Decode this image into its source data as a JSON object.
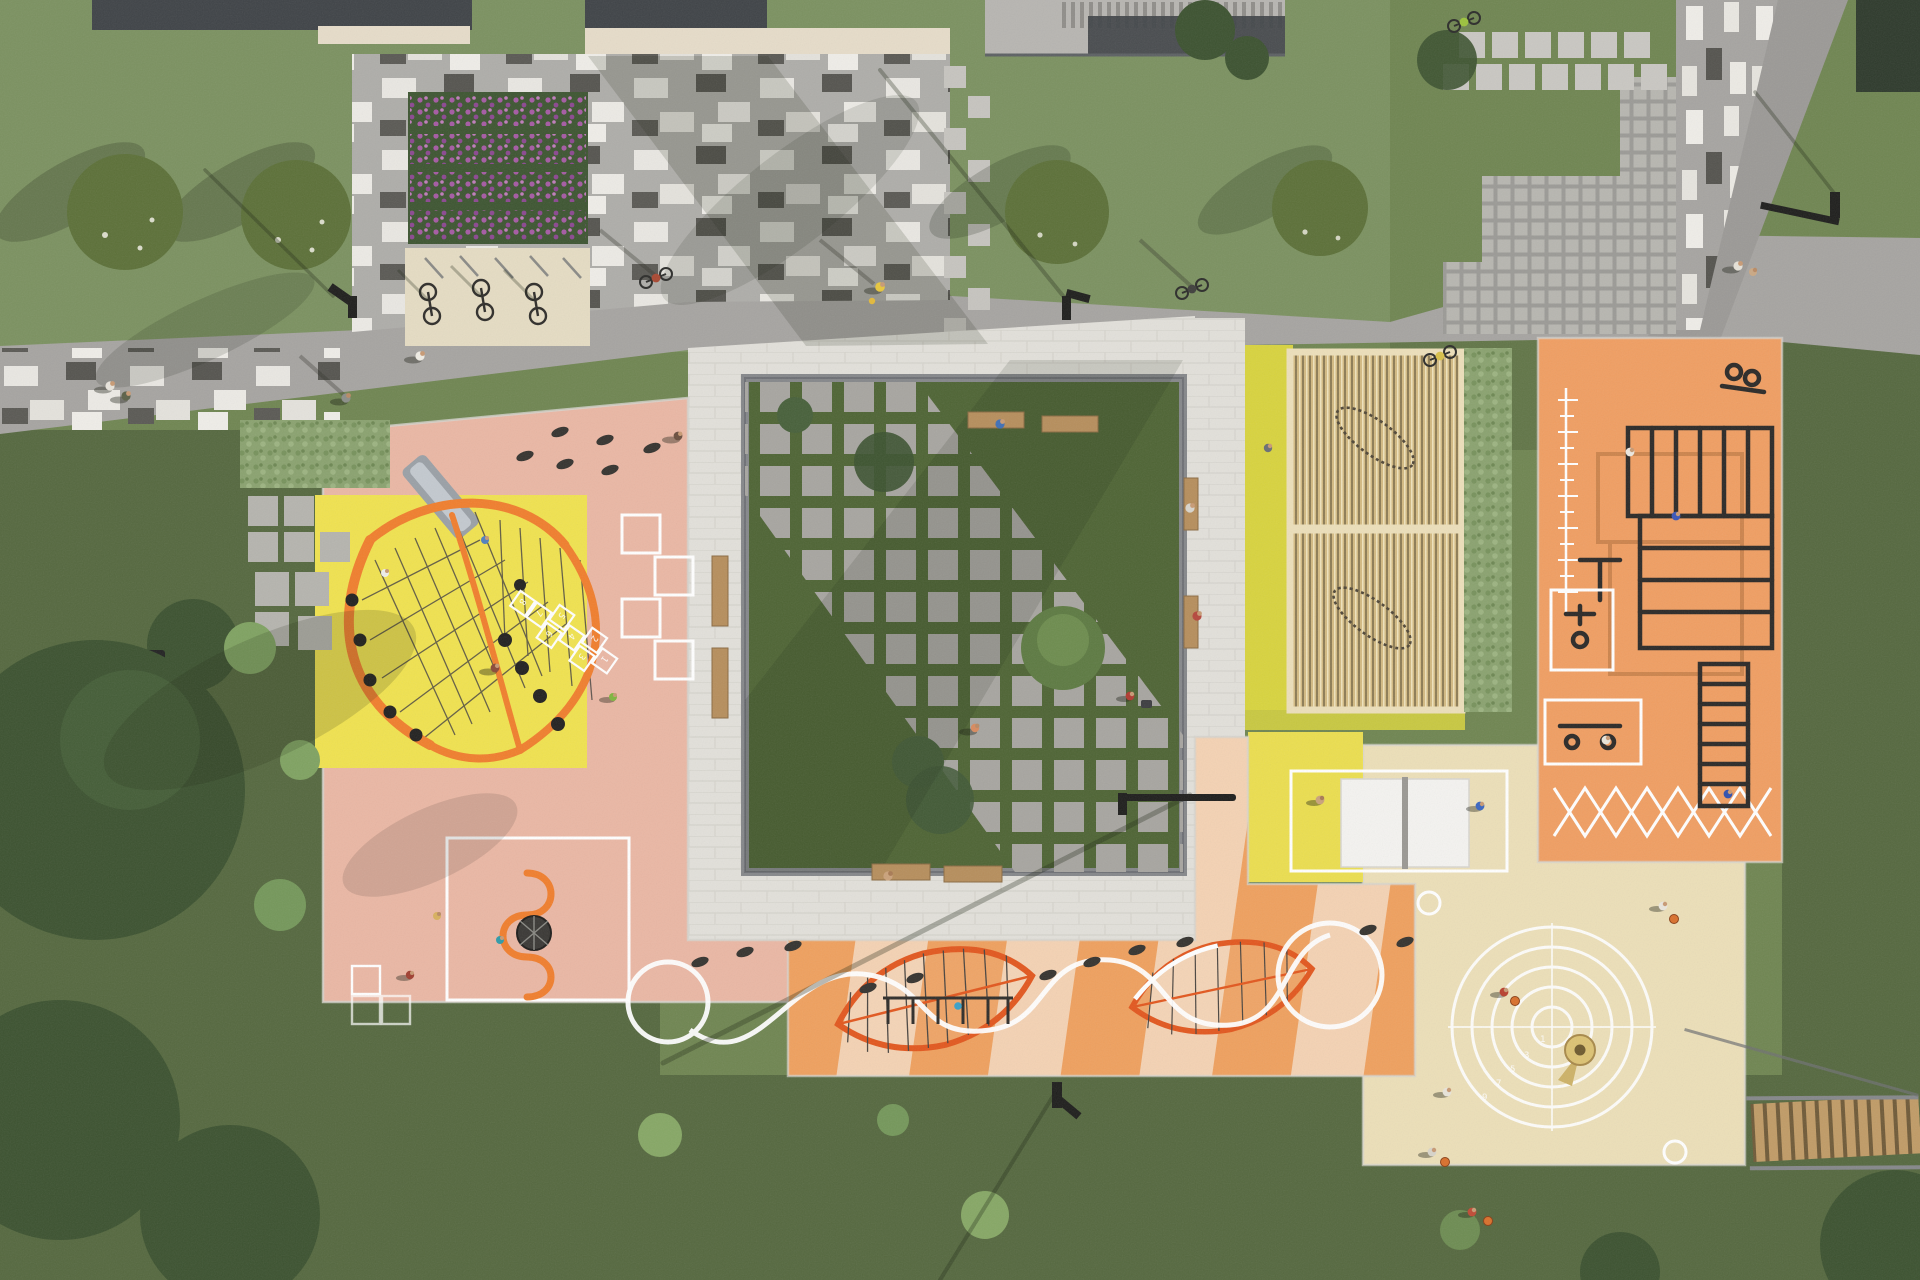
{
  "meta": {
    "description": "Top-down aerial 3D architectural render of a public park and playground masterplan",
    "render_style": "photorealistic site-plan visualization, no UI text"
  },
  "palette": {
    "c-grass": "#6f8551",
    "c-grass_light": "#7b9160",
    "c-grass_dark": "#55683f",
    "c-canopy": "#3c5230",
    "c-road": "#a6a4a1",
    "c-road_dark": "#9b9996",
    "c-plaza": "#aeada9",
    "c-paver_white": "#e2e0da",
    "c-lawn": "#4e6434",
    "c-wall": "#85878a",
    "c-wood": "#b68e5c",
    "c-pink": "#eab7a4",
    "c-yellow": "#f0e24f",
    "c-orange_frame": "#f07e2d",
    "c-lounge": "#d8d33e",
    "c-pergola": "#d3ba82",
    "c-fitness": "#f09e62",
    "c-stripe_o": "#efa05e",
    "c-stripe_c": "#f4d2b3",
    "c-leaf": "#e2571e",
    "c-beige": "#ecdfb8",
    "c-white": "#ffffff",
    "c-black": "#2b2927",
    "c-flower": "#a55aa3",
    "c-roof": "#3f4347",
    "c-trim": "#e6dcc9",
    "c-deck": "#b7b5b1",
    "c-stairs": "#c09b66"
  },
  "zones": [
    {
      "id": "north-lawn",
      "name": "Lawn with two flowering trees"
    },
    {
      "id": "flower-beds",
      "name": "Four rows of purple perennial planting"
    },
    {
      "id": "bicycle-parking",
      "name": "Bicycle racks with parked bikes on a sand pad"
    },
    {
      "id": "cobble-plaza",
      "name": "Grey plaza with scattered white and dark pavers"
    },
    {
      "id": "promenade",
      "name": "Grey paved pedestrian promenade with cyclists and walkers"
    },
    {
      "id": "northeast-path",
      "name": "Paver path with scattered vertical white setts and diagonal side road"
    },
    {
      "id": "grid-paver-terrace",
      "name": "Stepped lawn-grid paver terrace with stepping-stone rows"
    },
    {
      "id": "central-square",
      "name": "Sunken green square with stone seat-edge, timber benches and diagonal stepping-stone band"
    },
    {
      "id": "playground-west",
      "name": "Salmon play surface: yellow net-climber square with slide, balance pods, hopscotch, white game frames, wheel spinner"
    },
    {
      "id": "hammock-lounge",
      "name": "Two timber-slat pergolas with hammocks on chartreuse surface"
    },
    {
      "id": "hedge-screen",
      "name": "Shrub hedge between lounge and workout court"
    },
    {
      "id": "calisthenics-court",
      "name": "Orange workout court: monkey bars, ladders, pull-up rigs, two machine stations, agility-ladder and X markings"
    },
    {
      "id": "playground-south",
      "name": "Striped orange surface with leaf-shaped climbing nets, white wave rope, balance pods and mini swing frame"
    },
    {
      "id": "table-tennis",
      "name": "Yellow pad with one white table-tennis table"
    },
    {
      "id": "games-court",
      "name": "Sand-beige court with numbered target rings, funnel ball game and corner circles; basketball players"
    },
    {
      "id": "timber-stairs",
      "name": "Wooden stair flight to the south-east lawn"
    },
    {
      "id": "south-meadow",
      "name": "Large meadow with mature tree canopies"
    },
    {
      "id": "buildings-north",
      "name": "Building roofs, louvred canopy and entrance deck with stairs"
    }
  ],
  "games": {
    "hopscotch": {
      "numbers": [
        "1",
        "2",
        "3",
        "4",
        "5",
        "6",
        "7",
        "8"
      ]
    },
    "target_rings": {
      "numbers": [
        "1",
        "3",
        "5",
        "7",
        "9"
      ]
    }
  },
  "inventory": {
    "pergolas": 2,
    "table_tennis_tables": 1,
    "leaf_climbing_nets": 2,
    "target_ring_count": 5,
    "flower_bed_rows": 4,
    "benches_central_square": 8
  }
}
